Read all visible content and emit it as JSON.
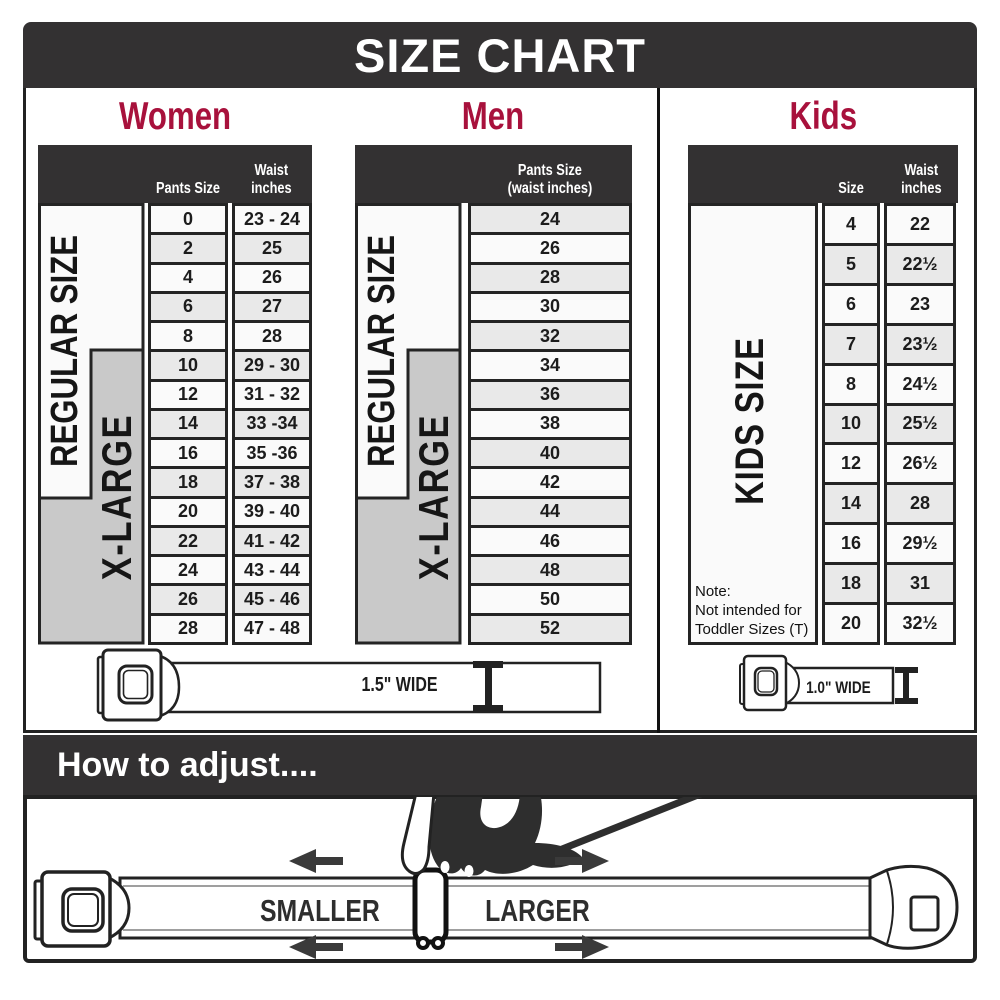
{
  "title": "SIZE CHART",
  "colors": {
    "accent_red": "#A8113C",
    "bar_dark": "#333132",
    "row_light": "#FAFAFA",
    "row_shaded": "#E9E9E9",
    "xlarge_gray": "#C9C9C9"
  },
  "women": {
    "title": "Women",
    "pants_header": "Pants Size",
    "waist_header": "Waist\ninches",
    "regular_label": "REGULAR SIZE",
    "xlarge_label": "X-LARGE",
    "rows": [
      [
        "0",
        "23 - 24"
      ],
      [
        "2",
        "25"
      ],
      [
        "4",
        "26"
      ],
      [
        "6",
        "27"
      ],
      [
        "8",
        "28"
      ],
      [
        "10",
        "29 - 30"
      ],
      [
        "12",
        "31 - 32"
      ],
      [
        "14",
        "33 -34"
      ],
      [
        "16",
        "35 -36"
      ],
      [
        "18",
        "37 - 38"
      ],
      [
        "20",
        "39 - 40"
      ],
      [
        "22",
        "41 - 42"
      ],
      [
        "24",
        "43 - 44"
      ],
      [
        "26",
        "45 - 46"
      ],
      [
        "28",
        "47 - 48"
      ]
    ]
  },
  "men": {
    "title": "Men",
    "header": "Pants Size\n(waist inches)",
    "regular_label": "REGULAR SIZE",
    "xlarge_label": "X-LARGE",
    "rows": [
      "24",
      "26",
      "28",
      "30",
      "32",
      "34",
      "36",
      "38",
      "40",
      "42",
      "44",
      "46",
      "48",
      "50",
      "52"
    ]
  },
  "kids": {
    "title": "Kids",
    "size_header": "Size",
    "waist_header": "Waist\ninches",
    "label": "KIDS SIZE",
    "note": "Note:\nNot intended for\nToddler Sizes (T)",
    "rows": [
      [
        "4",
        "22"
      ],
      [
        "5",
        "22½"
      ],
      [
        "6",
        "23"
      ],
      [
        "7",
        "23½"
      ],
      [
        "8",
        "24½"
      ],
      [
        "10",
        "25½"
      ],
      [
        "12",
        "26½"
      ],
      [
        "14",
        "28"
      ],
      [
        "16",
        "29½"
      ],
      [
        "18",
        "31"
      ],
      [
        "20",
        "32½"
      ]
    ]
  },
  "belts": {
    "adult_width_label": "1.5\" WIDE",
    "kids_width_label": "1.0\" WIDE"
  },
  "how_to": {
    "title": "How to adjust....",
    "smaller_label": "SMALLER",
    "larger_label": "LARGER"
  }
}
